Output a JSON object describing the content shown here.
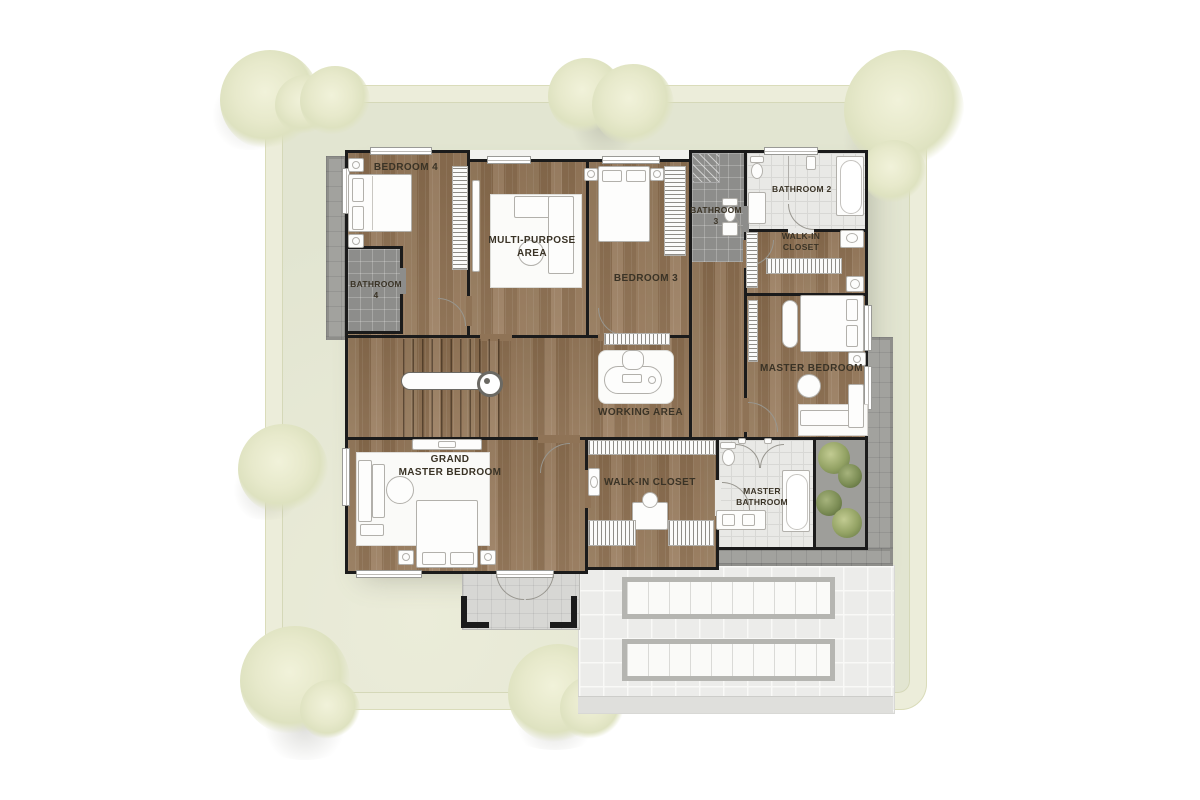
{
  "plan": {
    "rooms": {
      "bedroom4": {
        "lines": [
          "BEDROOM 4"
        ]
      },
      "multi_purpose": {
        "lines": [
          "MULTI-PURPOSE",
          "AREA"
        ]
      },
      "bedroom3": {
        "lines": [
          "BEDROOM 3"
        ]
      },
      "bathroom3": {
        "lines": [
          "BATHROOM",
          "3"
        ]
      },
      "bathroom2": {
        "lines": [
          "BATHROOM 2"
        ]
      },
      "walk_in_closet_top": {
        "lines": [
          "WALK-IN",
          "CLOSET"
        ]
      },
      "master_bedroom": {
        "lines": [
          "MASTER BEDROOM"
        ]
      },
      "bathroom4": {
        "lines": [
          "BATHROOM",
          "4"
        ]
      },
      "working_area": {
        "lines": [
          "WORKING AREA"
        ]
      },
      "grand_master_bedroom": {
        "lines": [
          "GRAND",
          "MASTER BEDROOM"
        ]
      },
      "walk_in_closet_bottom": {
        "lines": [
          "WALK-IN CLOSET"
        ]
      },
      "master_bathroom": {
        "lines": [
          "MASTER",
          "BATHROOM"
        ]
      }
    },
    "colors": {
      "wall": "#1b1b1b",
      "wood_floor": "#8f7356",
      "dark_tile": "#8d8d8b",
      "light_tile": "#e9e9e6",
      "terrace": "#a2a29e",
      "roof": "#ececea",
      "lawn": "#e2e5d1",
      "hedge": "#ecedda",
      "tree": "#e7e9cb",
      "plant_green": "#93a264",
      "label_text": "#3a3326"
    }
  }
}
